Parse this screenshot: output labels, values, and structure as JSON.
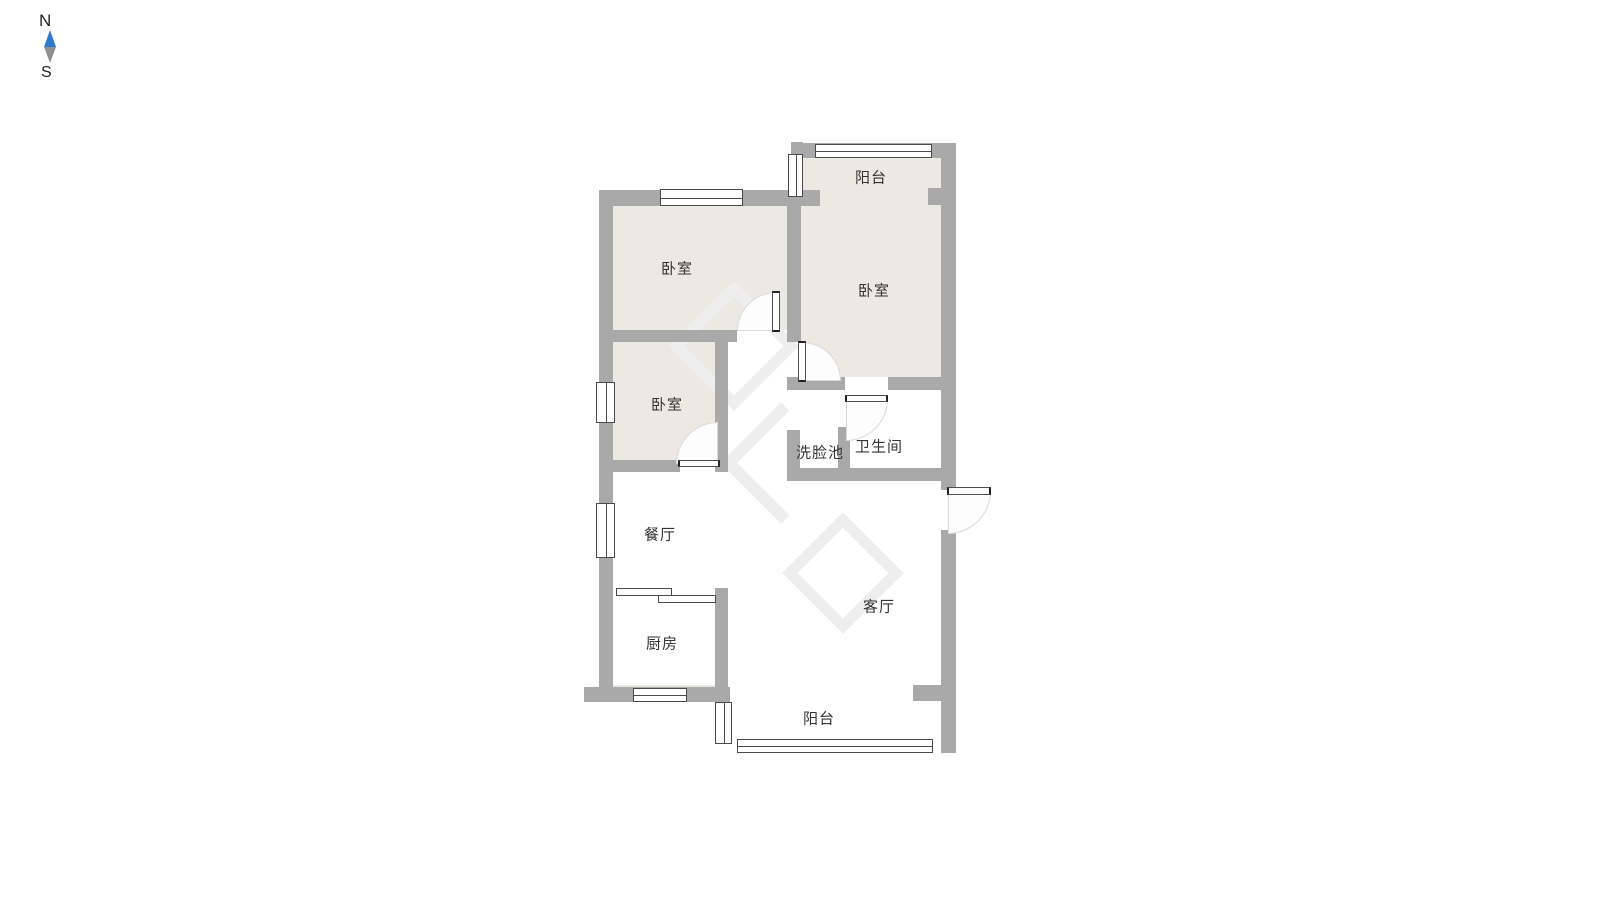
{
  "compass": {
    "north_label": "N",
    "south_label": "S",
    "needle_north_color": "#2e7bd0",
    "needle_south_color": "#8f9193"
  },
  "floor_plan": {
    "colors": {
      "wall": "#a9a9a9",
      "room_fill": "#ece9e2",
      "floor_fill": "#ffffff",
      "window_border": "#4a4a4a",
      "door_arc": "#d9d9d9",
      "label_text": "#333333"
    },
    "rooms": {
      "balcony_top": {
        "label": "阳台"
      },
      "bedroom_right": {
        "label": "卧室"
      },
      "bedroom_top_left": {
        "label": "卧室"
      },
      "bedroom_mid_left": {
        "label": "卧室"
      },
      "washbasin": {
        "label": "洗脸池"
      },
      "bathroom": {
        "label": "卫生间"
      },
      "dining_room": {
        "label": "餐厅"
      },
      "kitchen": {
        "label": "厨房"
      },
      "living_room": {
        "label": "客厅"
      },
      "balcony_bottom": {
        "label": "阳台"
      }
    }
  }
}
